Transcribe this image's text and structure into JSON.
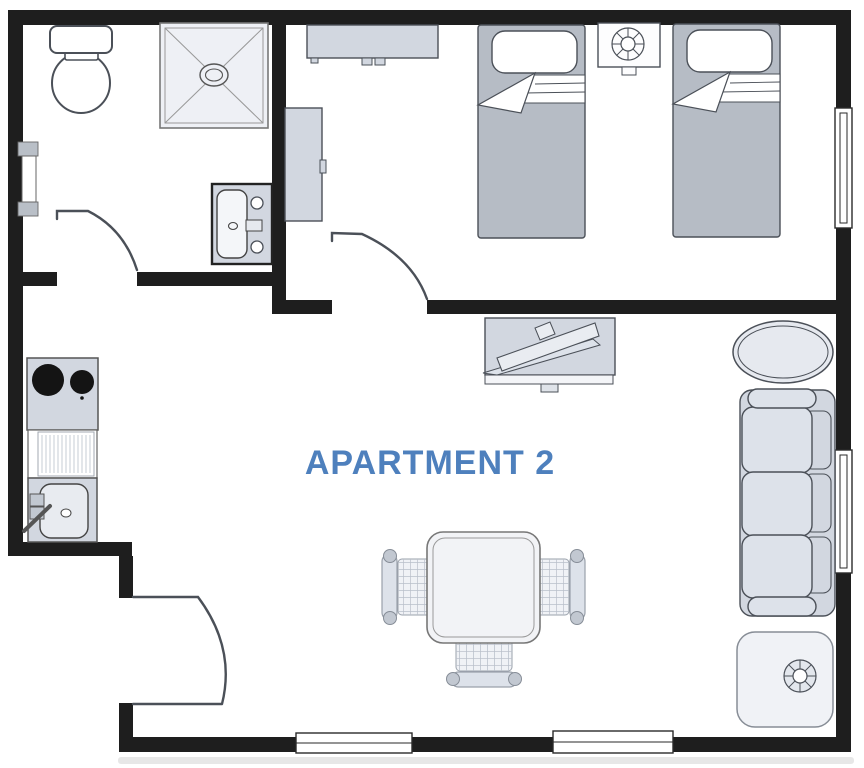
{
  "title": {
    "label": "APARTMENT 2"
  },
  "colors": {
    "accent": "#4e80bd",
    "wall": "#1e1e1e",
    "line": "#4b5058",
    "line_soft": "#9aa1ab",
    "furn": "#d2d7e0",
    "furn_light": "#dde2ea",
    "furn_pale": "#f0f2f6",
    "bed": "#b6bcc5",
    "knob": "#c2c8d1",
    "burner": "#141414",
    "window_cap": "#b9bfc7"
  },
  "plan": {
    "rooms": [
      "bathroom",
      "bedroom",
      "living-dining-kitchen"
    ],
    "furniture": [
      "toilet",
      "shower",
      "bathroom-sink",
      "wardrobe",
      "dresser",
      "single-bed-1",
      "nightstand-with-fan",
      "single-bed-2",
      "tv-cabinet",
      "oval-table",
      "sofa",
      "corner-table-with-fan",
      "stove-top",
      "kitchen-drainer",
      "kitchen-sink",
      "dining-table",
      "dining-chairs"
    ],
    "openings": [
      "bathroom-door",
      "bedroom-door",
      "entry-door",
      "bathroom-window",
      "bedroom-window",
      "living-window",
      "bottom-window-1",
      "bottom-window-2"
    ]
  }
}
